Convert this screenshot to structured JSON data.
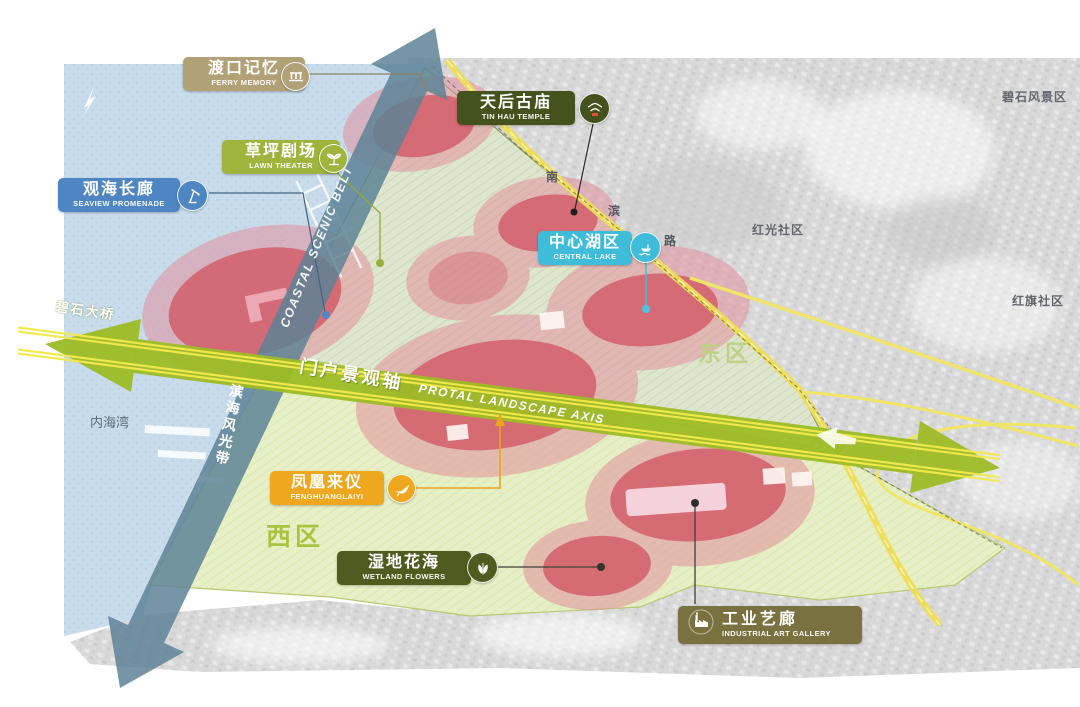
{
  "title": "coastal park masterplan diagram",
  "labels": [
    {
      "id": "ferry-memory",
      "zh": "渡口记忆",
      "en": "FERRY MEMORY",
      "color": "#b2a176",
      "icon": "pier-icon"
    },
    {
      "id": "lawn-theater",
      "zh": "草坪剧场",
      "en": "LAWN THEATER",
      "color": "#9fb43c",
      "icon": "sprout-icon"
    },
    {
      "id": "seaview-promenade",
      "zh": "观海长廊",
      "en": "SEAVIEW PROMENADE",
      "color": "#4d86c3",
      "icon": "crane-icon"
    },
    {
      "id": "tin-hau-temple",
      "zh": "天后古庙",
      "en": "TIN HAU TEMPLE",
      "color": "#44531d",
      "icon": "temple-icon"
    },
    {
      "id": "central-lake",
      "zh": "中心湖区",
      "en": "CENTRAL LAKE",
      "color": "#3fbcd9",
      "icon": "boat-icon"
    },
    {
      "id": "fenghuanglaiyi",
      "zh": "凤凰来仪",
      "en": "FENGHUANGLAIYI",
      "color": "#efa71f",
      "icon": "phoenix-icon"
    },
    {
      "id": "wetland-flowers",
      "zh": "湿地花海",
      "en": "WETLAND FLOWERS",
      "color": "#4e5c20",
      "icon": "butterfly-icon"
    },
    {
      "id": "industrial-art-gallery",
      "zh": "工业艺廊",
      "en": "INDUSTRIAL ART GALLERY",
      "color": "#7a7140",
      "icon": "factory-icon"
    }
  ],
  "axes": {
    "portal": {
      "zh": "门户景观轴",
      "en": "PROTAL LANDSCAPE AXIS",
      "color": "#9cbc25"
    },
    "coastal": {
      "zh": "滨海风光带",
      "en": "COASTAL SCENIC BELT",
      "color": "#5c8296"
    }
  },
  "bridge": "碧石大桥",
  "road": {
    "chars": [
      "南",
      "滨",
      "路"
    ]
  },
  "zones": {
    "east": "东区",
    "west": "西区"
  },
  "surroundings": {
    "bay": "内海湾",
    "hongguang": "红光社区",
    "hongqi": "红旗社区",
    "bishi_scenic": "碧石风景区"
  },
  "colors": {
    "water": "#c7dbeb",
    "park_east": "#dde6cd",
    "park_west": "#e6efc4",
    "hotspot_core": "#d25663",
    "hotspot_halo": "#e2919d",
    "road_yellow": "#eedd55",
    "aerial_gray": "#d8d8d8"
  }
}
